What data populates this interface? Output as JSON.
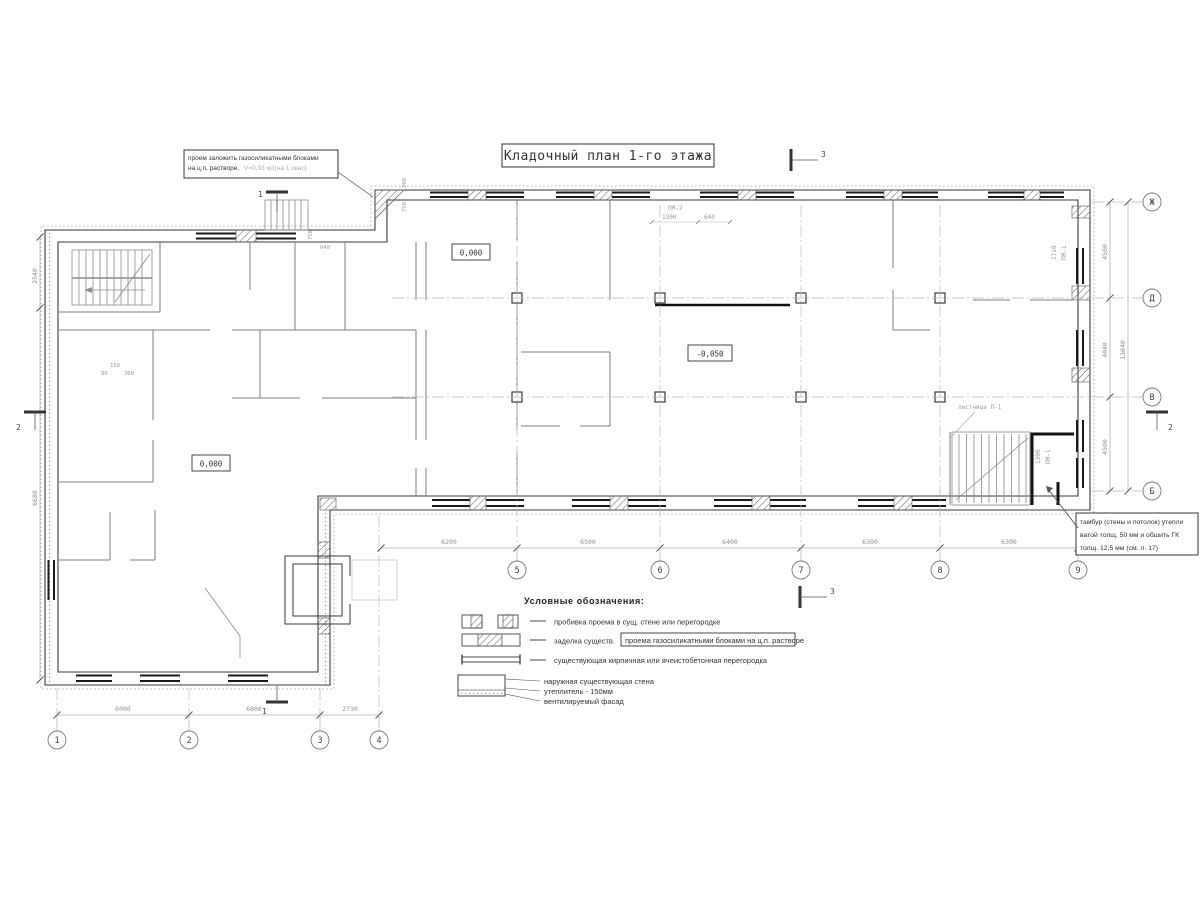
{
  "title": "Кладочный план 1-го этажа",
  "notes": {
    "opening": {
      "line1": "проем заложить газосиликатными блоками",
      "line2": "на ц.п. растворе.",
      "line2_gray": "V=0,93 м3(на 1 окно)"
    },
    "tambour": {
      "line1": "тамбур (стены и потолок) утепли",
      "line2": "ватой толщ. 50 мм и обшить ГК",
      "line3": "толщ. 12,5 мм (см. л. 17)"
    }
  },
  "elevations": {
    "hall_zero": "0,000",
    "hall_low": "-0,050",
    "wing_zero": "0,000"
  },
  "labels": {
    "stair": "лестница Л-1",
    "pm2": "ПМ-2",
    "pm2_d1": "1300",
    "pm2_d2": "640",
    "pm1_top": "ПМ-1",
    "pm1_top_d": "1710",
    "pm1_bot": "ПМ-1",
    "pm1_bot_d": "1300",
    "d150": "150",
    "d80": "80",
    "d300": "300",
    "d750a": "750",
    "d640": "640",
    "d200": "200",
    "d750b": "750"
  },
  "axes": {
    "cols_main": [
      "5",
      "6",
      "7",
      "8",
      "9"
    ],
    "cols_left": [
      "1",
      "2",
      "3",
      "4"
    ],
    "rows": [
      "Ж",
      "Д",
      "В",
      "Б"
    ]
  },
  "dims": {
    "bottom_main": [
      "6200",
      "6500",
      "6400",
      "6300",
      "6300"
    ],
    "bottom_left": [
      "6000",
      "6800",
      "2730"
    ],
    "right": [
      "4500",
      "4040",
      "4500"
    ],
    "right_total": "13040",
    "left": [
      "2540",
      "6680"
    ]
  },
  "sections": {
    "s1": "1",
    "s2": "2",
    "s3": "3"
  },
  "legend": {
    "title": "Условные обозначения:",
    "item1": "пробивка проема  в сущ. стене  или перегородке",
    "item2_plain": "заделка существ.",
    "item2_boxed": "проема газосиликатными блоками на ц.п. растворе",
    "item3": "существующая кирпичная или ячеистобетонная перегородка",
    "wall1": "наружная существующая стена",
    "wall2": "утеплитель - 150мм",
    "wall3": "вентилируемый фасад"
  },
  "colors": {
    "wall": "#3a3a3a",
    "window": "#1a1a1a",
    "dim": "#9a9a9a",
    "accent_dark": "#111111"
  }
}
